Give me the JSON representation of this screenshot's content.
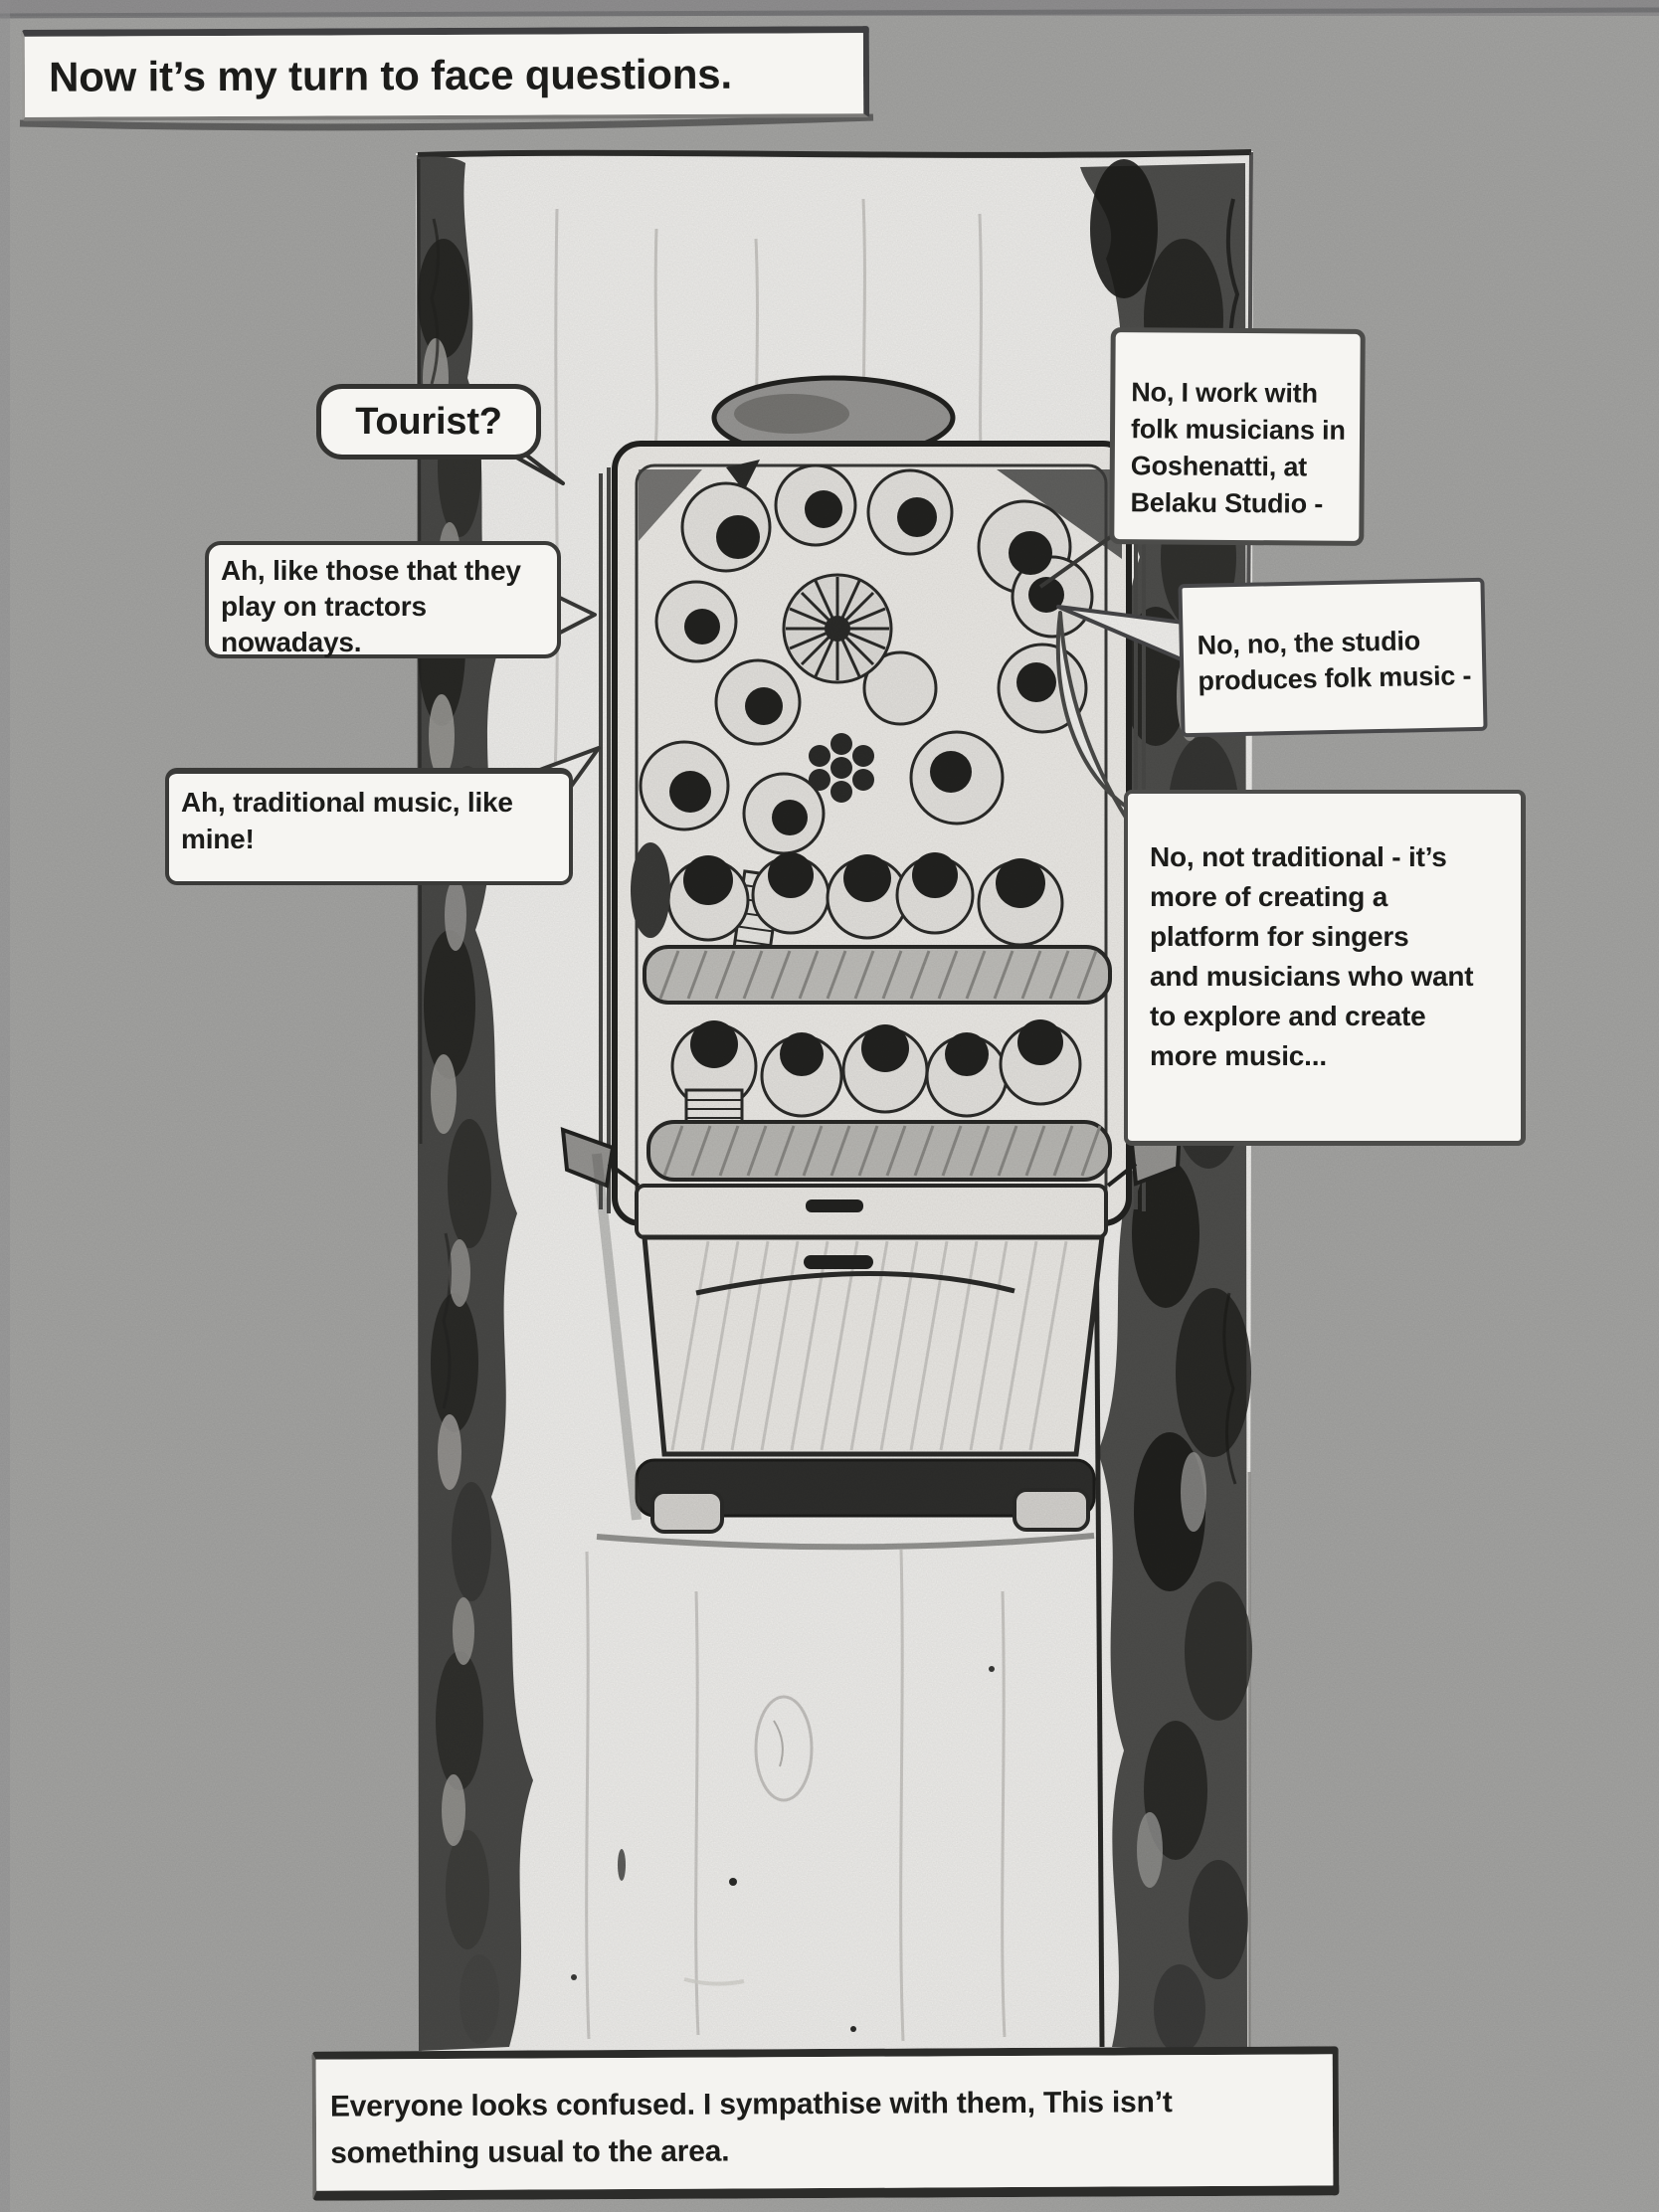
{
  "comic": {
    "captions": {
      "top": "Now it’s my turn to face questions.",
      "bottom_lines": [
        "Everyone looks confused. I sympathise with them, This isn’t",
        "something usual to the area."
      ]
    },
    "bubbles": {
      "tourist": "Tourist?",
      "tractors_lines": [
        "Ah, like those that they",
        "play on tractors",
        "nowadays."
      ],
      "traditional_lines": [
        "Ah, traditional music, like",
        "mine!"
      ],
      "folk_lines": [
        "No, I work with",
        "folk musicians in",
        "Goshenatti, at",
        "Belaku Studio -"
      ],
      "studio_lines": [
        "No, no, the studio",
        "produces folk music -"
      ],
      "not_traditional_lines": [
        "No, not traditional - it’s",
        "more of creating a",
        "platform for singers",
        "and musicians who want",
        "to explore and create",
        "more music..."
      ]
    },
    "colors": {
      "background": "#a8a8a6",
      "paper_white": "#f5f4f1",
      "ink": "#222220",
      "foliage_dark": "#1e1e1c"
    }
  }
}
